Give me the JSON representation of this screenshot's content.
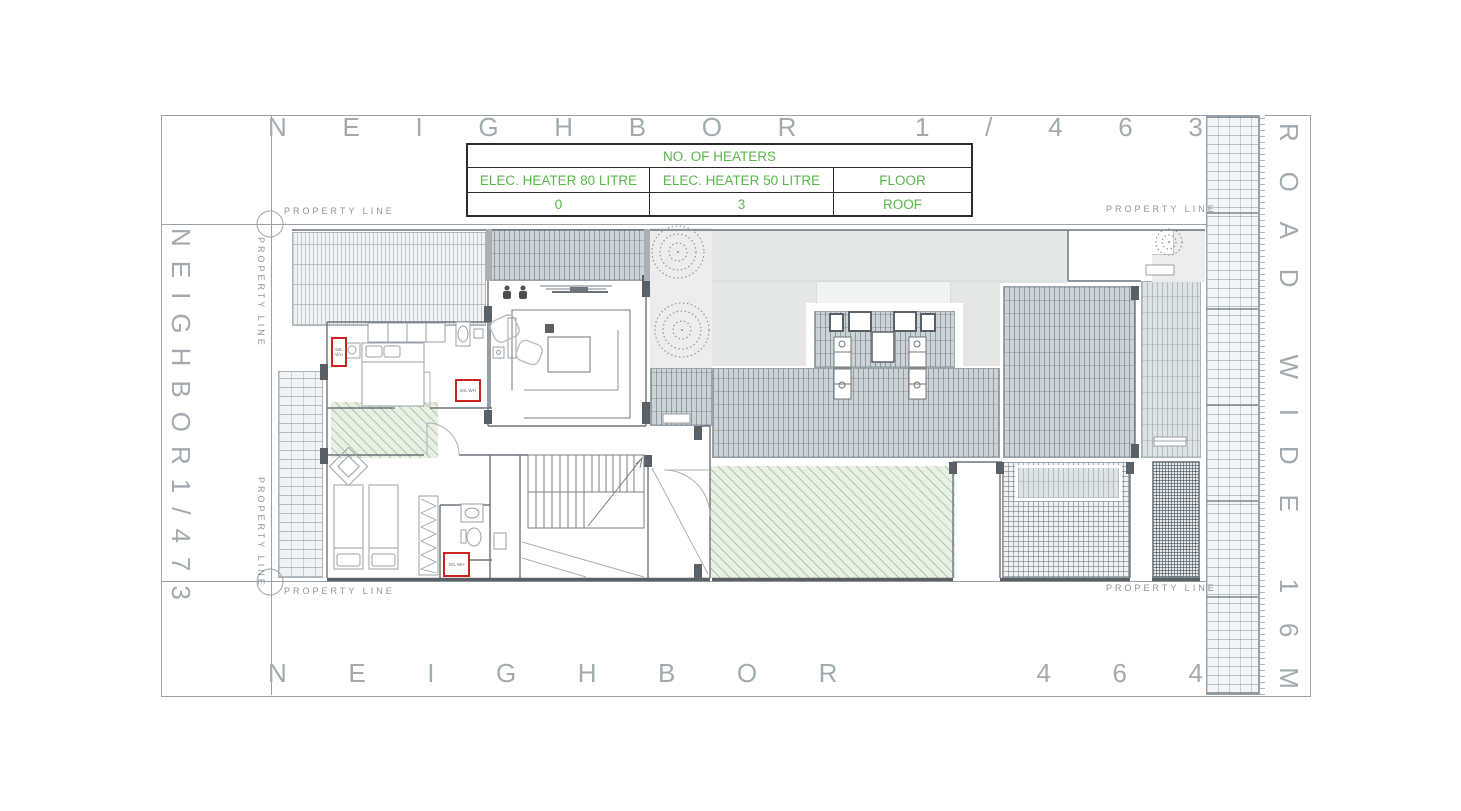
{
  "frame": {
    "neighbor_top": "NEIGHBOR 1/463",
    "neighbor_bottom": "NEIGHBOR  464",
    "neighbor_left": "NEIGHBOR1/473",
    "road_right": "ROAD WIDE 16M",
    "property_line": "PROPERTY LINE"
  },
  "heaters_table": {
    "title": "NO. OF HEATERS",
    "columns": [
      "ELEC. HEATER 80 LITRE",
      "ELEC. HEATER 50 LITRE",
      "FLOOR"
    ],
    "values": [
      "0",
      "3",
      "ROOF"
    ]
  },
  "plan": {
    "heater_tag": "50L WH"
  },
  "colors": {
    "drawing_gray": "#9aa2a7",
    "table_green": "#58b749",
    "heater_red": "#c9241f"
  }
}
